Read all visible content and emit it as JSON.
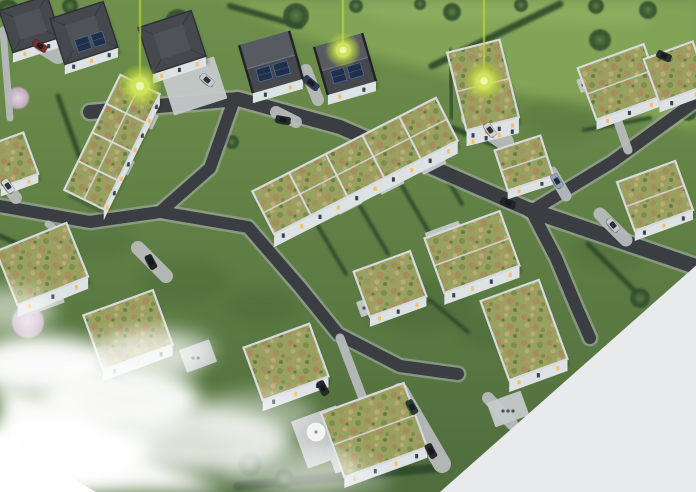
{
  "scene": {
    "width": 696,
    "height": 492,
    "palette": {
      "page_bg": "#ffffff",
      "cut_bg": "#e8eaec",
      "grass_top": "#6f8f4c",
      "grass_bottom": "#4f6d3d",
      "field_light": "#85a758",
      "field_light2": "#95b366",
      "lawn_shade": "#2e4a28",
      "road": "#3a3d41",
      "curb": "#a6abaa",
      "drive": "#b7bbbc",
      "pad": "#c5c9ca",
      "wall": "#dde2e5",
      "wall_shade": "#b2bcc2",
      "parapet": "#d6dadc",
      "roof_dark": "#45484d",
      "roof_dark_light": "#575b61",
      "ridge": "#70757c",
      "gable_end": "#212326",
      "solar": "#20304a",
      "solar_line": "#4f6f9f",
      "sedum_base": "#98a160",
      "sedum_brown": "#aa8a5c",
      "sedum_tan": "#c2a878",
      "sedum_green": "#7e8c4e",
      "sedum_dark": "#6e7a44",
      "hedge": "#2f4a2b",
      "tree": "#33512e",
      "tree_light": "#5d7f45",
      "blossom": "#c4a6c2",
      "blossom_light": "#e9dbe8",
      "window_warm": "#f4c06a",
      "window_dark": "#39434c",
      "marker": "#b9d636",
      "marker_mid": "#cfe45c",
      "marker_core": "#f0f7b8",
      "fog": "#ffffff",
      "shadow": "#16230f",
      "furniture": "#4b4e50"
    },
    "terrain": {
      "fields": [
        {
          "pts": "225,0 700,0 700,130 510,92 295,34",
          "fill": "field_light",
          "op": 0.9
        },
        {
          "pts": "340,0 650,0 648,26 385,20",
          "fill": "field_light2",
          "op": 0.55
        }
      ],
      "shades": [
        [
          420,
          305,
          55,
          26,
          0.18
        ],
        [
          185,
          282,
          45,
          22,
          0.15
        ],
        [
          565,
          118,
          45,
          20,
          0.12
        ],
        [
          262,
          305,
          38,
          18,
          0.15
        ],
        [
          95,
          240,
          40,
          18,
          0.12
        ],
        [
          610,
          250,
          40,
          18,
          0.15
        ],
        [
          500,
          330,
          40,
          18,
          0.15
        ]
      ]
    },
    "hedges": [
      [
        432,
        66,
        560,
        4,
        7
      ],
      [
        452,
        128,
        540,
        162,
        6
      ],
      [
        318,
        226,
        346,
        274,
        4
      ],
      [
        360,
        206,
        388,
        254,
        4
      ],
      [
        402,
        186,
        430,
        234,
        4
      ],
      [
        440,
        166,
        462,
        204,
        4
      ],
      [
        238,
        486,
        436,
        468,
        9
      ],
      [
        58,
        96,
        80,
        158,
        5
      ],
      [
        430,
        300,
        468,
        332,
        4
      ],
      [
        584,
        130,
        650,
        118,
        4
      ],
      [
        588,
        244,
        640,
        296,
        5
      ],
      [
        230,
        6,
        300,
        26,
        6
      ],
      [
        0,
        236,
        36,
        252,
        5
      ],
      [
        96,
        364,
        150,
        396,
        6
      ],
      [
        450,
        50,
        452,
        118,
        4
      ]
    ],
    "trees": [
      {
        "x": 8,
        "y": 10,
        "r": 11,
        "k": "t"
      },
      {
        "x": 70,
        "y": 6,
        "r": 8,
        "k": "t"
      },
      {
        "x": 178,
        "y": 22,
        "r": 13,
        "k": "t"
      },
      {
        "x": 296,
        "y": 16,
        "r": 13,
        "k": "t"
      },
      {
        "x": 356,
        "y": 6,
        "r": 7,
        "k": "t"
      },
      {
        "x": 420,
        "y": 4,
        "r": 6,
        "k": "t"
      },
      {
        "x": 452,
        "y": 12,
        "r": 9,
        "k": "t"
      },
      {
        "x": 521,
        "y": 5,
        "r": 7,
        "k": "t"
      },
      {
        "x": 596,
        "y": 6,
        "r": 8,
        "k": "t"
      },
      {
        "x": 648,
        "y": 10,
        "r": 9,
        "k": "t"
      },
      {
        "x": 600,
        "y": 40,
        "r": 11,
        "k": "t"
      },
      {
        "x": 688,
        "y": 112,
        "r": 9,
        "k": "t"
      },
      {
        "x": 640,
        "y": 298,
        "r": 10,
        "k": "t"
      },
      {
        "x": 100,
        "y": 198,
        "r": 7,
        "k": "t"
      },
      {
        "x": 232,
        "y": 142,
        "r": 7,
        "k": "t"
      },
      {
        "x": 250,
        "y": 464,
        "r": 12,
        "k": "t"
      },
      {
        "x": 284,
        "y": 479,
        "r": 10,
        "k": "t"
      },
      {
        "x": 18,
        "y": 98,
        "r": 11,
        "k": "b"
      },
      {
        "x": 28,
        "y": 322,
        "r": 16,
        "k": "b"
      }
    ],
    "roads": [
      {
        "pts": [
          [
            90,
            112
          ],
          [
            238,
            99
          ],
          [
            340,
            127
          ],
          [
            530,
            210
          ]
        ],
        "w": 14
      },
      {
        "pts": [
          [
            530,
            210
          ],
          [
            700,
            268
          ]
        ],
        "w": 15
      },
      {
        "pts": [
          [
            533,
            210
          ],
          [
            612,
            162
          ],
          [
            700,
            98
          ]
        ],
        "w": 12
      },
      {
        "pts": [
          [
            234,
            100
          ],
          [
            210,
            168
          ],
          [
            160,
            212
          ],
          [
            90,
            222
          ],
          [
            0,
            206
          ]
        ],
        "w": 12
      },
      {
        "pts": [
          [
            160,
            212
          ],
          [
            248,
            227
          ],
          [
            300,
            287
          ],
          [
            338,
            334
          ],
          [
            400,
            366
          ],
          [
            458,
            374
          ]
        ],
        "w": 12
      },
      {
        "pts": [
          [
            532,
            212
          ],
          [
            556,
            258
          ],
          [
            576,
            306
          ],
          [
            590,
            338
          ]
        ],
        "w": 12
      }
    ],
    "driveways": [
      {
        "pts": [
          [
            3,
            30
          ],
          [
            10,
            118
          ]
        ],
        "w": 7
      },
      {
        "pts": [
          [
            28,
            38
          ],
          [
            58,
            56
          ]
        ],
        "w": 16
      },
      {
        "pts": [
          [
            306,
            70
          ],
          [
            318,
            100
          ]
        ],
        "w": 12
      },
      {
        "pts": [
          [
            470,
            118
          ],
          [
            505,
            142
          ]
        ],
        "w": 18
      },
      {
        "pts": [
          [
            600,
            214
          ],
          [
            626,
            240
          ]
        ],
        "w": 13
      },
      {
        "pts": [
          [
            138,
            248
          ],
          [
            166,
            276
          ]
        ],
        "w": 14
      },
      {
        "pts": [
          [
            340,
            338
          ],
          [
            362,
            396
          ]
        ],
        "w": 9
      },
      {
        "pts": [
          [
            400,
            392
          ],
          [
            442,
            464
          ]
        ],
        "w": 18
      },
      {
        "pts": [
          [
            0,
            176
          ],
          [
            16,
            198
          ]
        ],
        "w": 12
      },
      {
        "pts": [
          [
            100,
            206
          ],
          [
            148,
            96
          ]
        ],
        "w": 6
      },
      {
        "pts": [
          [
            48,
            224
          ],
          [
            70,
            240
          ]
        ],
        "w": 7
      },
      {
        "pts": [
          [
            488,
            398
          ],
          [
            512,
            424
          ]
        ],
        "w": 12
      },
      {
        "pts": [
          [
            552,
            172
          ],
          [
            566,
            196
          ]
        ],
        "w": 11
      },
      {
        "pts": [
          [
            616,
            116
          ],
          [
            628,
            150
          ]
        ],
        "w": 9
      },
      {
        "pts": [
          [
            276,
            112
          ],
          [
            296,
            122
          ]
        ],
        "w": 12
      }
    ],
    "pads": [
      [
        166,
        64,
        56,
        44,
        -18,
        0
      ],
      [
        22,
        286,
        40,
        24,
        -20,
        2
      ],
      [
        182,
        344,
        32,
        24,
        -20,
        2
      ],
      [
        428,
        226,
        36,
        26,
        -20,
        2
      ],
      [
        298,
        412,
        48,
        50,
        -20,
        0
      ],
      [
        490,
        396,
        36,
        26,
        -20,
        3
      ],
      [
        292,
        212,
        26,
        18,
        -27,
        2
      ],
      [
        334,
        192,
        26,
        18,
        -27,
        2
      ],
      [
        376,
        172,
        26,
        18,
        -27,
        2
      ],
      [
        418,
        152,
        26,
        18,
        -27,
        1
      ],
      [
        142,
        114,
        16,
        12,
        -64,
        1
      ],
      [
        118,
        160,
        16,
        12,
        -64,
        1
      ],
      [
        358,
        298,
        22,
        16,
        -20,
        1
      ],
      [
        250,
        348,
        24,
        18,
        -20,
        2
      ],
      [
        578,
        76,
        20,
        14,
        -20,
        2
      ],
      [
        330,
        442,
        26,
        28,
        -20,
        3
      ]
    ],
    "houses": [
      {
        "n": "house-existing-1",
        "t": "hip",
        "x": 30,
        "y": 24,
        "w": 50,
        "d": 44,
        "rot": -18,
        "wh": 10,
        "solar": false
      },
      {
        "n": "house-existing-2",
        "t": "hip",
        "x": 84,
        "y": 33,
        "w": 56,
        "d": 48,
        "rot": -18,
        "wh": 10,
        "solar": true
      },
      {
        "n": "house-existing-3",
        "t": "hip",
        "x": 172,
        "y": 42,
        "w": 56,
        "d": 48,
        "rot": -18,
        "wh": 10,
        "solar": false
      },
      {
        "n": "house-gable-solar-1",
        "t": "gable",
        "x": 271,
        "y": 62,
        "w": 52,
        "d": 50,
        "rot": -16,
        "wh": 10,
        "solar": true
      },
      {
        "n": "house-gable-solar-2",
        "t": "gable",
        "x": 345,
        "y": 64,
        "w": 50,
        "d": 50,
        "rot": -16,
        "wh": 10,
        "solar": true
      },
      {
        "n": "apartment-building",
        "t": "apartment",
        "x": 483,
        "y": 85,
        "w": 54,
        "d": 80,
        "rot": -14,
        "wh": 16,
        "ridge": true
      },
      {
        "n": "house-east-1",
        "t": "green",
        "x": 620,
        "y": 82,
        "w": 70,
        "d": 55,
        "rot": -20,
        "wh": 10,
        "ridge": true
      },
      {
        "n": "house-east-2",
        "t": "green",
        "x": 676,
        "y": 72,
        "w": 52,
        "d": 46,
        "rot": -20,
        "wh": 10
      },
      {
        "n": "house-center-east",
        "t": "green",
        "x": 524,
        "y": 163,
        "w": 48,
        "d": 42,
        "rot": -18,
        "wh": 9,
        "ridge": true
      },
      {
        "n": "house-east-3",
        "t": "green",
        "x": 655,
        "y": 196,
        "w": 62,
        "d": 52,
        "rot": -20,
        "wh": 10,
        "ridge": true
      },
      {
        "n": "townhouse-row-1",
        "t": "row",
        "x": 112,
        "y": 142,
        "w": 128,
        "d": 44,
        "rot": -64,
        "units": 4,
        "wh": 11,
        "ridge": true
      },
      {
        "n": "townhouse-row-2",
        "t": "row",
        "x": 355,
        "y": 166,
        "w": 206,
        "d": 48,
        "rot": -27,
        "units": 5,
        "wh": 13,
        "ridge": true
      },
      {
        "n": "house-west-1",
        "t": "green",
        "x": 42,
        "y": 264,
        "w": 76,
        "d": 58,
        "rot": -22,
        "wh": 12
      },
      {
        "n": "house-west-2",
        "t": "green",
        "x": 128,
        "y": 330,
        "w": 74,
        "d": 58,
        "rot": -20,
        "wh": 11
      },
      {
        "n": "house-mid-1",
        "t": "green",
        "x": 390,
        "y": 284,
        "w": 60,
        "d": 48,
        "rot": -20,
        "wh": 10
      },
      {
        "n": "house-mid-2",
        "t": "green",
        "x": 472,
        "y": 252,
        "w": 80,
        "d": 58,
        "rot": -20,
        "wh": 12,
        "ridge": true
      },
      {
        "n": "house-south-east",
        "t": "green",
        "x": 524,
        "y": 330,
        "w": 62,
        "d": 84,
        "rot": -20,
        "wh": 12
      },
      {
        "n": "house-south-1",
        "t": "green",
        "x": 286,
        "y": 362,
        "w": 70,
        "d": 56,
        "rot": -20,
        "wh": 11
      },
      {
        "n": "house-south-2",
        "t": "green",
        "x": 374,
        "y": 430,
        "w": 88,
        "d": 68,
        "rot": -20,
        "wh": 11,
        "ridge": true
      },
      {
        "n": "house-left-edge",
        "t": "green",
        "x": 12,
        "y": 160,
        "w": 40,
        "d": 44,
        "rot": -20,
        "wh": 9
      }
    ],
    "cars": [
      {
        "x": 40,
        "y": 46,
        "a": 33,
        "c": "#7b2d27"
      },
      {
        "x": 207,
        "y": 80,
        "a": 40,
        "c": "#c9ccce"
      },
      {
        "x": 311,
        "y": 83,
        "a": 40,
        "c": "#2e3c58",
        "l": 18
      },
      {
        "x": 490,
        "y": 130,
        "a": 55,
        "c": "#cdd0d3"
      },
      {
        "x": 664,
        "y": 56,
        "a": 24,
        "c": "#2a2d31"
      },
      {
        "x": 557,
        "y": 181,
        "a": 58,
        "c": "#8fa3bd"
      },
      {
        "x": 613,
        "y": 225,
        "a": 50,
        "c": "#c6c9cb"
      },
      {
        "x": 508,
        "y": 203,
        "a": 22,
        "c": "#222527"
      },
      {
        "x": 151,
        "y": 262,
        "a": 62,
        "c": "#1e2124"
      },
      {
        "x": 283,
        "y": 120,
        "a": 10,
        "c": "#26292c"
      },
      {
        "x": 323,
        "y": 388,
        "a": 62,
        "c": "#26292d"
      },
      {
        "x": 412,
        "y": 407,
        "a": 60,
        "c": "#2c3d2f"
      },
      {
        "x": 431,
        "y": 451,
        "a": 62,
        "c": "#26292d"
      },
      {
        "x": 8,
        "y": 186,
        "a": 55,
        "c": "#d5d7d8"
      }
    ],
    "parasol": {
      "x": 316,
      "y": 432,
      "r": 10
    },
    "fog": {
      "blobs": [
        [
          40,
          365,
          70,
          30,
          0.97
        ],
        [
          120,
          400,
          80,
          34,
          0.95
        ],
        [
          205,
          440,
          85,
          32,
          0.8
        ],
        [
          60,
          450,
          90,
          36,
          0.99
        ],
        [
          290,
          468,
          70,
          24,
          0.45
        ],
        [
          160,
          350,
          55,
          22,
          0.5
        ],
        [
          10,
          310,
          45,
          22,
          0.55
        ],
        [
          255,
          415,
          60,
          24,
          0.4
        ],
        [
          330,
          480,
          60,
          18,
          0.3
        ],
        [
          140,
          360,
          60,
          24,
          0.5
        ]
      ],
      "corner_soft": "0,492 0,382 55,400 140,452 230,492",
      "corner_solid": "0,492 0,436 96,492"
    },
    "cut_polygon": "440,492 700,262 700,492",
    "markers": [
      {
        "id": "marker-1",
        "x": 140,
        "y": 86,
        "r": 11
      },
      {
        "id": "marker-2",
        "x": 343,
        "y": 50,
        "r": 9
      },
      {
        "id": "marker-3",
        "x": 484,
        "y": 81,
        "r": 10
      }
    ]
  }
}
